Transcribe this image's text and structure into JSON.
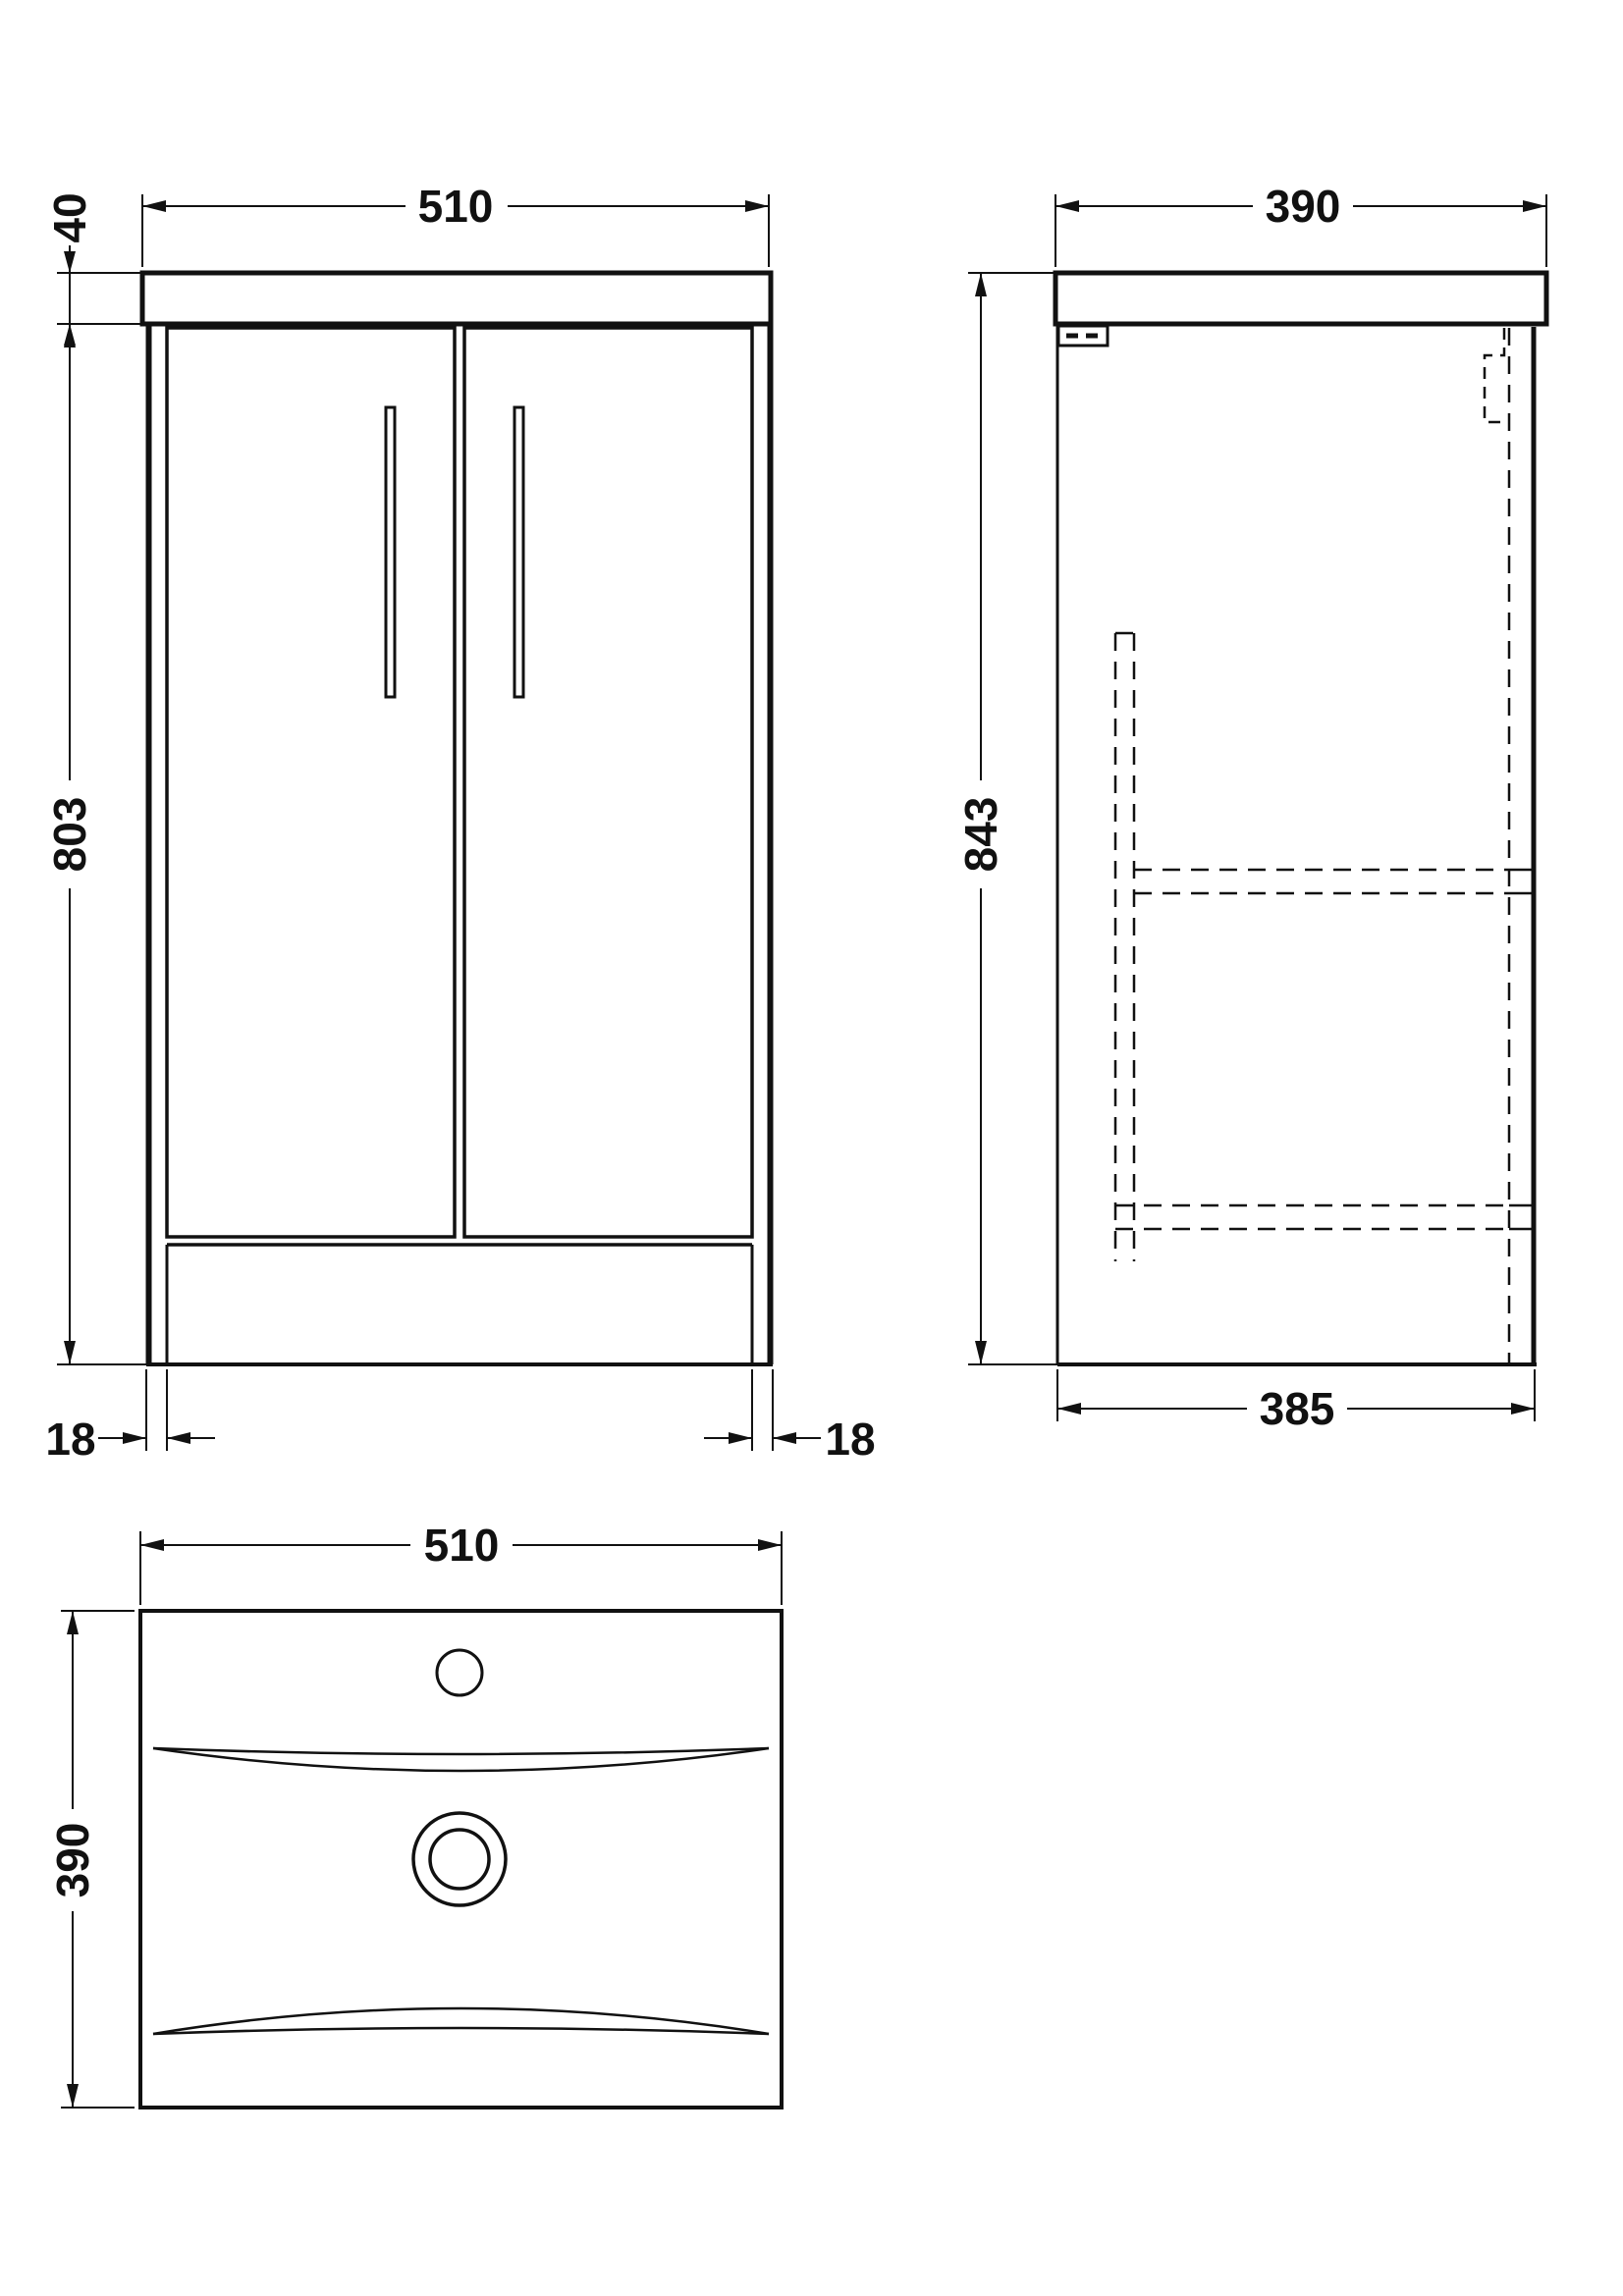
{
  "drawing": {
    "type": "technical-orthographic-drawing",
    "subject": "vanity unit with basin",
    "front_view": {
      "width_label": "510",
      "countertop_thickness_label": "40",
      "body_height_label": "803",
      "left_leg_width_label": "18",
      "right_leg_width_label": "18"
    },
    "side_view": {
      "depth_label": "390",
      "overall_height_label": "843",
      "base_depth_label": "385"
    },
    "plan_view": {
      "width_label": "510",
      "depth_label": "390"
    }
  },
  "colors": {
    "line": "#111111",
    "background": "#ffffff"
  }
}
